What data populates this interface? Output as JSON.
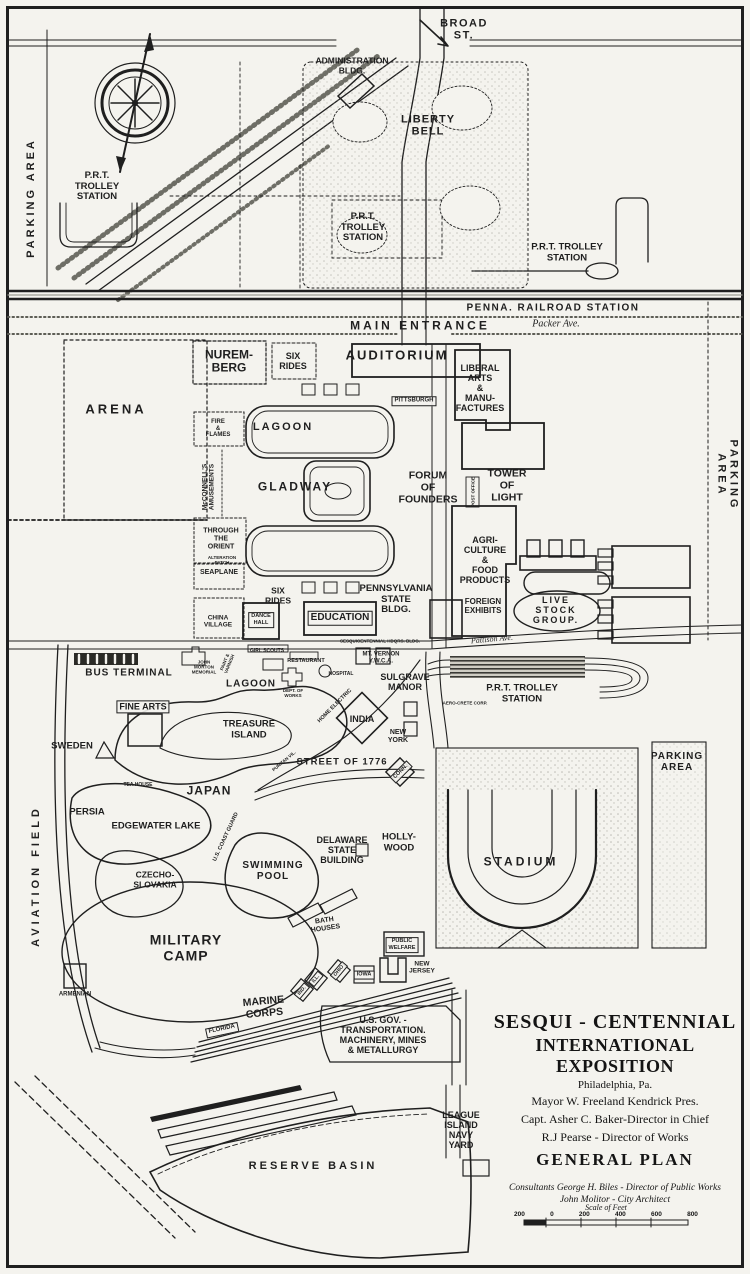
{
  "map": {
    "colors": {
      "ink": "#1f1f1f",
      "paper": "#f4f3ee",
      "halftone": "#777777"
    },
    "compass": "north-compass-rose",
    "labels": [
      {
        "n": "label-broad-st",
        "t": "BROAD\nST.",
        "x": 464,
        "y": 30,
        "fs": 11,
        "ls": 1.5
      },
      {
        "n": "label-administration-bldg",
        "t": "ADMINISTRATION\nBLDG.",
        "x": 352,
        "y": 66,
        "fs": 8.5
      },
      {
        "n": "label-liberty-bell",
        "t": "LIBERTY\nBELL",
        "x": 428,
        "y": 126,
        "fs": 11,
        "ls": 1
      },
      {
        "n": "label-parking-area-left",
        "t": "PARKING AREA",
        "x": 31,
        "y": 198,
        "fs": 11,
        "rot": -90,
        "ls": 3
      },
      {
        "n": "label-prt-trolley-station-nw",
        "t": "P.R.T.\nTROLLEY\nSTATION",
        "x": 97,
        "y": 187,
        "fs": 9.5
      },
      {
        "n": "label-prt-trolley-station-mid",
        "t": "P.R.T.\nTROLLEY\nSTATION",
        "x": 363,
        "y": 228,
        "fs": 9.5
      },
      {
        "n": "label-prt-trolley-station-ne",
        "t": "P.R.T. TROLLEY\nSTATION",
        "x": 567,
        "y": 253,
        "fs": 9.5
      },
      {
        "n": "label-penna-railroad-station",
        "t": "PENNA. RAILROAD STATION",
        "x": 553,
        "y": 308,
        "fs": 10,
        "ls": 1.5
      },
      {
        "n": "label-main-entrance",
        "t": "MAIN ENTRANCE",
        "x": 420,
        "y": 326,
        "fs": 12,
        "ls": 3
      },
      {
        "n": "label-packer-ave",
        "t": "Packer Ave.",
        "x": 556,
        "y": 324,
        "fs": 10,
        "serif": 1,
        "it": 1
      },
      {
        "n": "label-nuremberg",
        "t": "NUREM-\nBERG",
        "x": 229,
        "y": 362,
        "fs": 12
      },
      {
        "n": "label-six-rides-upper",
        "t": "SIX\nRIDES",
        "x": 293,
        "y": 361,
        "fs": 9
      },
      {
        "n": "label-auditorium",
        "t": "AUDITORIUM",
        "x": 397,
        "y": 356,
        "fs": 13,
        "ls": 2
      },
      {
        "n": "label-liberal-arts",
        "t": "LIBERAL\nARTS\n&\nMANU-\nFACTURES",
        "x": 480,
        "y": 388,
        "fs": 9
      },
      {
        "n": "label-arena",
        "t": "ARENA",
        "x": 116,
        "y": 410,
        "fs": 13,
        "ls": 3
      },
      {
        "n": "label-fire-and-flames",
        "t": "FIRE\n&\nFLAMES",
        "x": 218,
        "y": 429,
        "fs": 6
      },
      {
        "n": "label-mcconnells-amusements",
        "t": "McCONNELL'S\nAMUSEMENTS",
        "x": 209,
        "y": 487,
        "fs": 6.5,
        "rot": -90
      },
      {
        "n": "label-lagoon-upper",
        "t": "LAGOON",
        "x": 283,
        "y": 427,
        "fs": 11,
        "ls": 2
      },
      {
        "n": "label-pittsburgh",
        "t": "PITTSBURGH",
        "x": 414,
        "y": 401,
        "fs": 6,
        "box": 1
      },
      {
        "n": "label-gladway",
        "t": "GLADWAY",
        "x": 295,
        "y": 487,
        "fs": 12,
        "ls": 2
      },
      {
        "n": "label-forum-of-founders",
        "t": "FORUM\nOF\nFOUNDERS",
        "x": 428,
        "y": 488,
        "fs": 10.5
      },
      {
        "n": "label-tower-of-light",
        "t": "TOWER\nOF\nLIGHT",
        "x": 507,
        "y": 486,
        "fs": 10.5
      },
      {
        "n": "label-post-office",
        "t": "POST OFFICE",
        "x": 473,
        "y": 492,
        "fs": 4.5,
        "rot": -90
      },
      {
        "n": "label-agriculture-food",
        "t": "AGRI-\nCULTURE\n&\nFOOD\nPRODUCTS",
        "x": 485,
        "y": 560,
        "fs": 9
      },
      {
        "n": "label-foreign-exhibits",
        "t": "FOREIGN\nEXHIBITS",
        "x": 483,
        "y": 607,
        "fs": 8
      },
      {
        "n": "label-live-stock-group",
        "t": "LIVE\nSTOCK\nGROUP.",
        "x": 556,
        "y": 610,
        "fs": 9,
        "ls": 2
      },
      {
        "n": "label-parking-area-right",
        "t": "PARKING AREA",
        "x": 727,
        "y": 475,
        "fs": 11,
        "rot": 90,
        "ls": 3
      },
      {
        "n": "label-through-the-orient",
        "t": "THROUGH\nTHE\nORIENT",
        "x": 221,
        "y": 539,
        "fs": 7
      },
      {
        "n": "label-alteration-patch",
        "t": "ALTERATION\nPATCH",
        "x": 222,
        "y": 560,
        "fs": 4.5
      },
      {
        "n": "label-seaplane",
        "t": "SEAPLANE",
        "x": 219,
        "y": 573,
        "fs": 7
      },
      {
        "n": "label-china-village",
        "t": "CHINA\nVILLAGE",
        "x": 218,
        "y": 622,
        "fs": 6.5
      },
      {
        "n": "label-six-rides-lower",
        "t": "SIX\nRIDES",
        "x": 278,
        "y": 596,
        "fs": 8.5
      },
      {
        "n": "label-pennsylvania-state-bldg",
        "t": "PENNSYLVANIA\nSTATE\nBLDG.",
        "x": 396,
        "y": 600,
        "fs": 9.5
      },
      {
        "n": "label-education",
        "t": "EDUCATION",
        "x": 340,
        "y": 618,
        "fs": 10,
        "box": 1
      },
      {
        "n": "label-dance-hall",
        "t": "DANCE\nHALL",
        "x": 261,
        "y": 620,
        "fs": 5.5,
        "box": 1
      },
      {
        "n": "label-bus-terminal",
        "t": "BUS TERMINAL",
        "x": 129,
        "y": 673,
        "fs": 10,
        "ls": 1
      },
      {
        "n": "label-john-morton-memorial",
        "t": "JOHN\nMORTON\nMEMORIAL",
        "x": 204,
        "y": 667,
        "fs": 4.5
      },
      {
        "n": "label-paint-varnish",
        "t": "PAINT &\nVARNISH",
        "x": 227,
        "y": 663,
        "fs": 4.5,
        "rot": -68
      },
      {
        "n": "label-girl-scouts",
        "t": "GIRL SCOUTS",
        "x": 267,
        "y": 652,
        "fs": 5
      },
      {
        "n": "label-restaurant",
        "t": "RESTAURANT",
        "x": 306,
        "y": 661,
        "fs": 5.5
      },
      {
        "n": "label-sesqui-hdqrs",
        "t": "SESQUICENTENNIAL HDQRS. BLDG.",
        "x": 380,
        "y": 641,
        "fs": 4.5
      },
      {
        "n": "label-pattison-ave",
        "t": "Pattison Ave.",
        "x": 492,
        "y": 640,
        "fs": 8,
        "serif": 1,
        "it": 1,
        "rot": -5
      },
      {
        "n": "label-mt-vernon-ywca",
        "t": "MT. VERNON\nY.W.C.A.",
        "x": 381,
        "y": 658,
        "fs": 6
      },
      {
        "n": "label-hospital",
        "t": "HOSPITAL",
        "x": 341,
        "y": 675,
        "fs": 5
      },
      {
        "n": "label-lagoon-lower",
        "t": "LAGOON",
        "x": 251,
        "y": 684,
        "fs": 10,
        "ls": 1
      },
      {
        "n": "label-dept-of-works",
        "t": "DEPT. OF\nWORKS",
        "x": 293,
        "y": 693,
        "fs": 4.5
      },
      {
        "n": "label-sulgrave-manor",
        "t": "SULGRAVE\nMANOR",
        "x": 405,
        "y": 682,
        "fs": 9
      },
      {
        "n": "label-home-electric",
        "t": "HOME ELECTRIC",
        "x": 335,
        "y": 706,
        "fs": 5.5,
        "rot": -45
      },
      {
        "n": "label-aero-crete-corp",
        "t": "AERO-CRETE CORP.",
        "x": 465,
        "y": 703,
        "fs": 4.5
      },
      {
        "n": "label-prt-trolley-station-s",
        "t": "P.R.T. TROLLEY\nSTATION",
        "x": 522,
        "y": 694,
        "fs": 9.5
      },
      {
        "n": "label-fine-arts",
        "t": "FINE ARTS",
        "x": 143,
        "y": 707,
        "fs": 9,
        "box": 1
      },
      {
        "n": "label-sweden",
        "t": "SWEDEN",
        "x": 72,
        "y": 747,
        "fs": 9.5
      },
      {
        "n": "label-treasure-island",
        "t": "TREASURE\nISLAND",
        "x": 249,
        "y": 730,
        "fs": 9.5
      },
      {
        "n": "label-india",
        "t": "INDIA",
        "x": 362,
        "y": 719,
        "fs": 9
      },
      {
        "n": "label-new-york",
        "t": "NEW\nYORK",
        "x": 398,
        "y": 737,
        "fs": 7
      },
      {
        "n": "label-tea-house",
        "t": "TEA HOUSE",
        "x": 138,
        "y": 786,
        "fs": 5
      },
      {
        "n": "label-japan",
        "t": "JAPAN",
        "x": 209,
        "y": 791,
        "fs": 12,
        "ls": 1
      },
      {
        "n": "label-street-of-1776",
        "t": "STREET OF 1776",
        "x": 342,
        "y": 763,
        "fs": 9.5,
        "ls": 1
      },
      {
        "n": "label-conn",
        "t": "CONN.",
        "x": 401,
        "y": 772,
        "fs": 5.5,
        "rot": -45,
        "box": 1
      },
      {
        "n": "label-puritan-vil",
        "t": "PURITAN VIL.",
        "x": 284,
        "y": 761,
        "fs": 4.5,
        "rot": -40
      },
      {
        "n": "label-parking-area-se",
        "t": "PARKING\nAREA",
        "x": 677,
        "y": 762,
        "fs": 10,
        "ls": 1
      },
      {
        "n": "label-stadium",
        "t": "STADIUM",
        "x": 521,
        "y": 862,
        "fs": 12,
        "ls": 3
      },
      {
        "n": "label-persia",
        "t": "PERSIA",
        "x": 87,
        "y": 813,
        "fs": 9.5
      },
      {
        "n": "label-edgewater-lake",
        "t": "EDGEWATER LAKE",
        "x": 156,
        "y": 827,
        "fs": 9.5
      },
      {
        "n": "label-czecho-slovakia",
        "t": "CZECHO-\nSLOVAKIA",
        "x": 155,
        "y": 880,
        "fs": 8.5
      },
      {
        "n": "label-swimming-pool",
        "t": "SWIMMING\nPOOL",
        "x": 273,
        "y": 871,
        "fs": 10,
        "ls": 1
      },
      {
        "n": "label-delaware-state-building",
        "t": "DELAWARE\nSTATE\nBUILDING",
        "x": 342,
        "y": 850,
        "fs": 9
      },
      {
        "n": "label-hollywood",
        "t": "HOLLY-\nWOOD",
        "x": 399,
        "y": 843,
        "fs": 9.5
      },
      {
        "n": "label-us-coast-guard",
        "t": "U.S. COAST GUARD",
        "x": 226,
        "y": 837,
        "fs": 5.5,
        "rot": -65
      },
      {
        "n": "label-military-camp",
        "t": "MILITARY\nCAMP",
        "x": 186,
        "y": 948,
        "fs": 14,
        "ls": 1
      },
      {
        "n": "label-bath-houses",
        "t": "BATH\nHOUSES",
        "x": 325,
        "y": 925,
        "fs": 7,
        "rot": -8
      },
      {
        "n": "label-public-welfare",
        "t": "PUBLIC\nWELFARE",
        "x": 402,
        "y": 945,
        "fs": 5.5,
        "box": 1
      },
      {
        "n": "label-armenian",
        "t": "ARMENIAN",
        "x": 75,
        "y": 995,
        "fs": 6
      },
      {
        "n": "label-marine-corps",
        "t": "MARINE\nCORPS",
        "x": 264,
        "y": 1008,
        "fs": 10.5,
        "rot": -5
      },
      {
        "n": "label-ind",
        "t": "IND.",
        "x": 302,
        "y": 991,
        "fs": 5,
        "rot": -50,
        "box": 1
      },
      {
        "n": "label-ill",
        "t": "ILL.",
        "x": 316,
        "y": 979,
        "fs": 5,
        "rot": -50,
        "box": 1
      },
      {
        "n": "label-ohio",
        "t": "OHIO",
        "x": 339,
        "y": 971,
        "fs": 5,
        "rot": -50,
        "box": 1
      },
      {
        "n": "label-iowa",
        "t": "IOWA",
        "x": 364,
        "y": 975,
        "fs": 5.5,
        "box": 1
      },
      {
        "n": "label-new-jersey",
        "t": "NEW\nJERSEY",
        "x": 422,
        "y": 968,
        "fs": 6.5
      },
      {
        "n": "label-florida",
        "t": "FLORIDA",
        "x": 222,
        "y": 1030,
        "fs": 6,
        "rot": -12,
        "box": 1
      },
      {
        "n": "label-us-gov",
        "t": "U.S. GOV. -\nTRANSPORTATION.\nMACHINERY, MINES\n& METALLURGY",
        "x": 383,
        "y": 1035,
        "fs": 9
      },
      {
        "n": "label-aviation-field",
        "t": "AVIATION FIELD",
        "x": 36,
        "y": 876,
        "fs": 11,
        "rot": -90,
        "ls": 4
      },
      {
        "n": "label-league-island-navy-yard",
        "t": "LEAGUE\nISLAND\nNAVY\nYARD",
        "x": 461,
        "y": 1130,
        "fs": 9
      },
      {
        "n": "label-reserve-basin",
        "t": "RESERVE BASIN",
        "x": 313,
        "y": 1166,
        "fs": 11,
        "ls": 3
      }
    ],
    "title_block": {
      "line1": "SESQUI - CENTENNIAL",
      "line2": "INTERNATIONAL EXPOSITION",
      "city": "Philadelphia, Pa.",
      "mayor": "Mayor W. Freeland Kendrick Pres.",
      "director_chief": "Capt. Asher C. Baker-Director in Chief",
      "director_works": "R.J Pearse - Director of Works",
      "plan": "GENERAL PLAN",
      "consultant1": "Consultants George H. Biles - Director of Public Works",
      "consultant2": "John Molitor - City Architect"
    },
    "scale": {
      "title": "Scale of Feet",
      "ticks": [
        "200",
        "0",
        "200",
        "400",
        "600",
        "800"
      ]
    }
  }
}
